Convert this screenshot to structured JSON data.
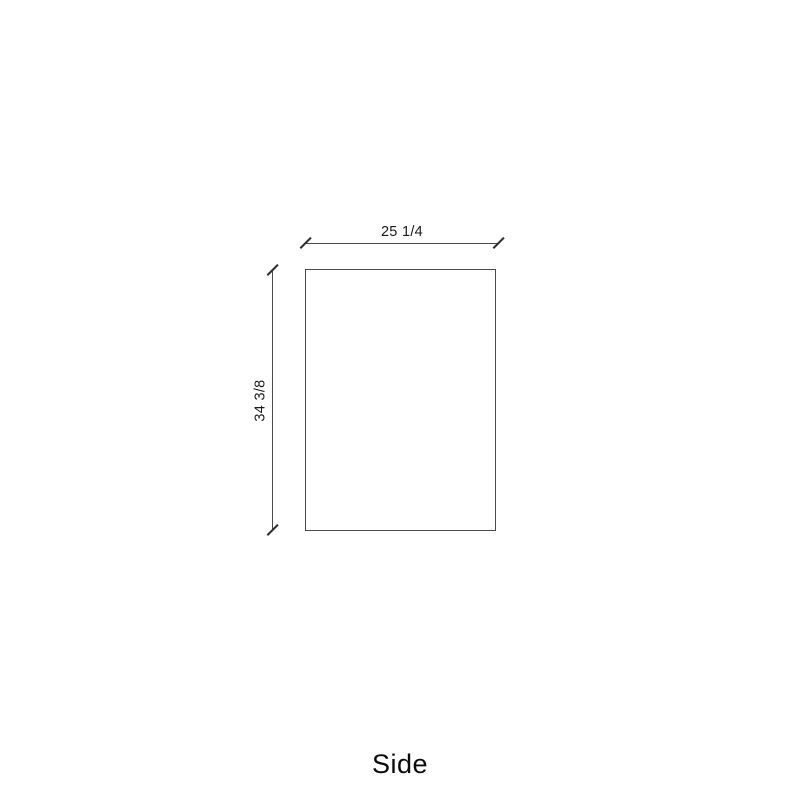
{
  "drawing": {
    "view_title": "Side",
    "width_dimension_label": "25 1/4",
    "height_dimension_label": "34 3/8"
  },
  "icons": {
    "tick_style": "slash-tick"
  },
  "colors": {
    "background": "#ffffff",
    "panel_outline": "#4a4a4a",
    "dimension_line": "#4a4a4a",
    "tick": "#2e2e2e",
    "dimension_text": "#1a1a1a",
    "title_text": "#0b0b0b"
  }
}
